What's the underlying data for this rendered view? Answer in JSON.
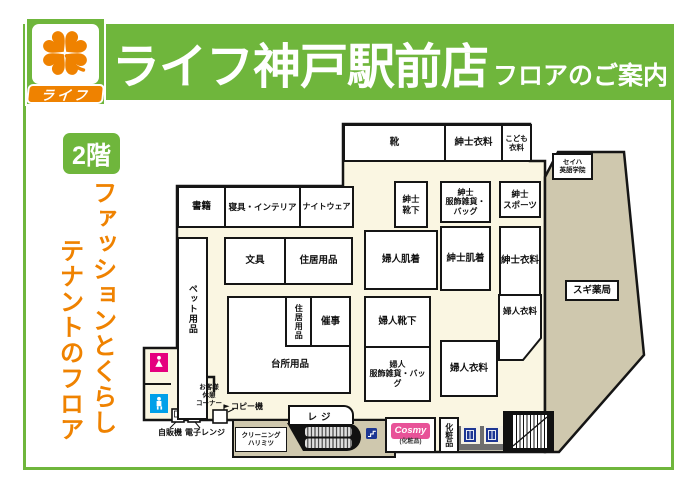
{
  "header": {
    "title": "ライフ神戸駅前店",
    "subtitle": "フロアのご案内",
    "logo_text": "ライフ"
  },
  "floor": {
    "badge": "2階",
    "tagline_line1": "ファッションとくらし",
    "tagline_line2": "テナントのフロア"
  },
  "rooms": {
    "shoes": "靴",
    "mens_clothing_top": "紳士衣料",
    "kids_clothing": "こども\n衣料",
    "books": "書籍",
    "bedding_interior": "寝具・インテリア",
    "nightwear": "ナイトウェア",
    "mens_socks": "紳士\n靴下",
    "mens_accessories_bags": "紳士\n服飾雑貨・\nバッグ",
    "mens_sports": "紳士\nスポーツ",
    "stationery": "文具",
    "household_goods_1": "住居用品",
    "womens_underwear": "婦人肌着",
    "mens_underwear": "紳士肌着",
    "mens_clothing_2": "紳士衣料",
    "pet_supplies": "ペット用品",
    "kitchen_goods": "台所用品",
    "household_goods_2": "住居用品",
    "events": "催事",
    "womens_socks": "婦人靴下",
    "womens_accessories_bags": "婦人\n服飾雑貨・バッグ",
    "womens_clothing_1": "婦人衣料",
    "womens_clothing_2": "婦人衣料"
  },
  "tenants": {
    "sugi_pharmacy": "スギ薬局",
    "seiha_english_academy": "セイハ\n英語学院",
    "cleaning_harimitsu": "クリーニング\nハリミツ",
    "cosmy": "Cosmy",
    "cosmy_note": "(化粧品)",
    "cosmetics": "化粧品"
  },
  "facilities": {
    "register": "レジ",
    "rest_corner": "お客様\n休憩\nコーナー",
    "copy_machine": "コピー機",
    "vending_machine": "自販機",
    "microwave": "電子レンジ"
  },
  "colors": {
    "brand_green": "#6fb63c",
    "brand_orange": "#ef8200",
    "floor_cream": "#faf6e2",
    "tenant_tan": "#cfc8ae",
    "cosmy_pink": "#e85298",
    "womens_wc_pink": "#e5007e",
    "mens_wc_blue": "#00a0e9",
    "icon_navy": "#1d3693"
  }
}
